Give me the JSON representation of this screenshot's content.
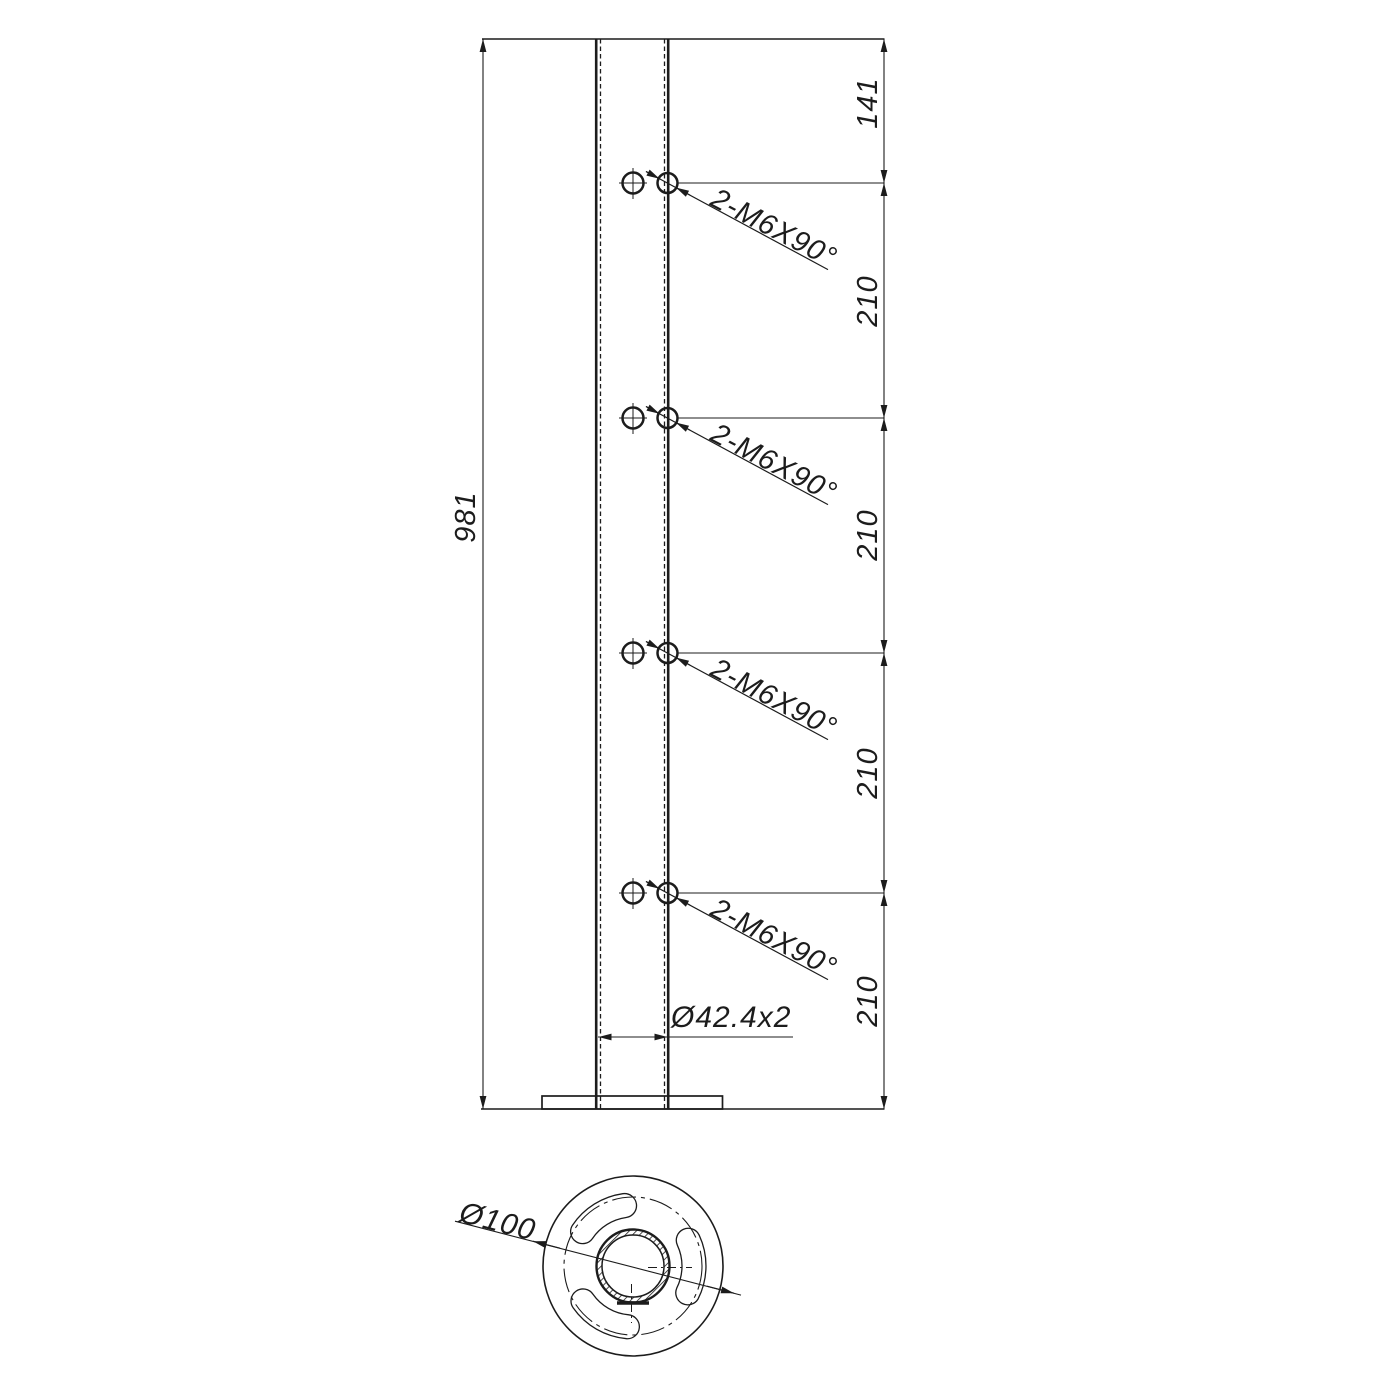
{
  "front_view": {
    "overall_height": "981",
    "top_offset": "141",
    "segment_spacings": [
      "210",
      "210",
      "210",
      "210"
    ],
    "hole_callouts": [
      "2-M6X90°",
      "2-M6X90°",
      "2-M6X90°",
      "2-M6X90°"
    ],
    "tube_dimension": "Ø42.4x2"
  },
  "bottom_view": {
    "base_diameter": "Ø100"
  },
  "style": {
    "line_color": "#1c1c1c",
    "background": "#ffffff"
  }
}
